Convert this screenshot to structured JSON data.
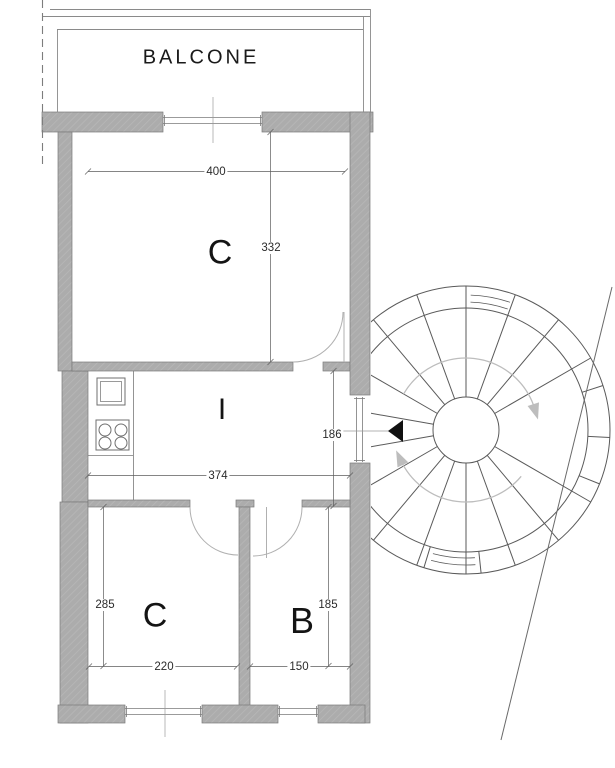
{
  "plan": {
    "balcony": {
      "label": "BALCONE"
    },
    "rooms": {
      "c_top": {
        "label": "C",
        "width": "400",
        "height": "332"
      },
      "i": {
        "label": "I",
        "width": "374",
        "height": "186"
      },
      "c_bottom": {
        "label": "C",
        "width": "220",
        "height": "285"
      },
      "b": {
        "label": "B",
        "width": "150",
        "height": "185"
      }
    },
    "colors": {
      "wall": "#acacac",
      "line": "#555555",
      "entrance_marker": "#111111"
    }
  }
}
